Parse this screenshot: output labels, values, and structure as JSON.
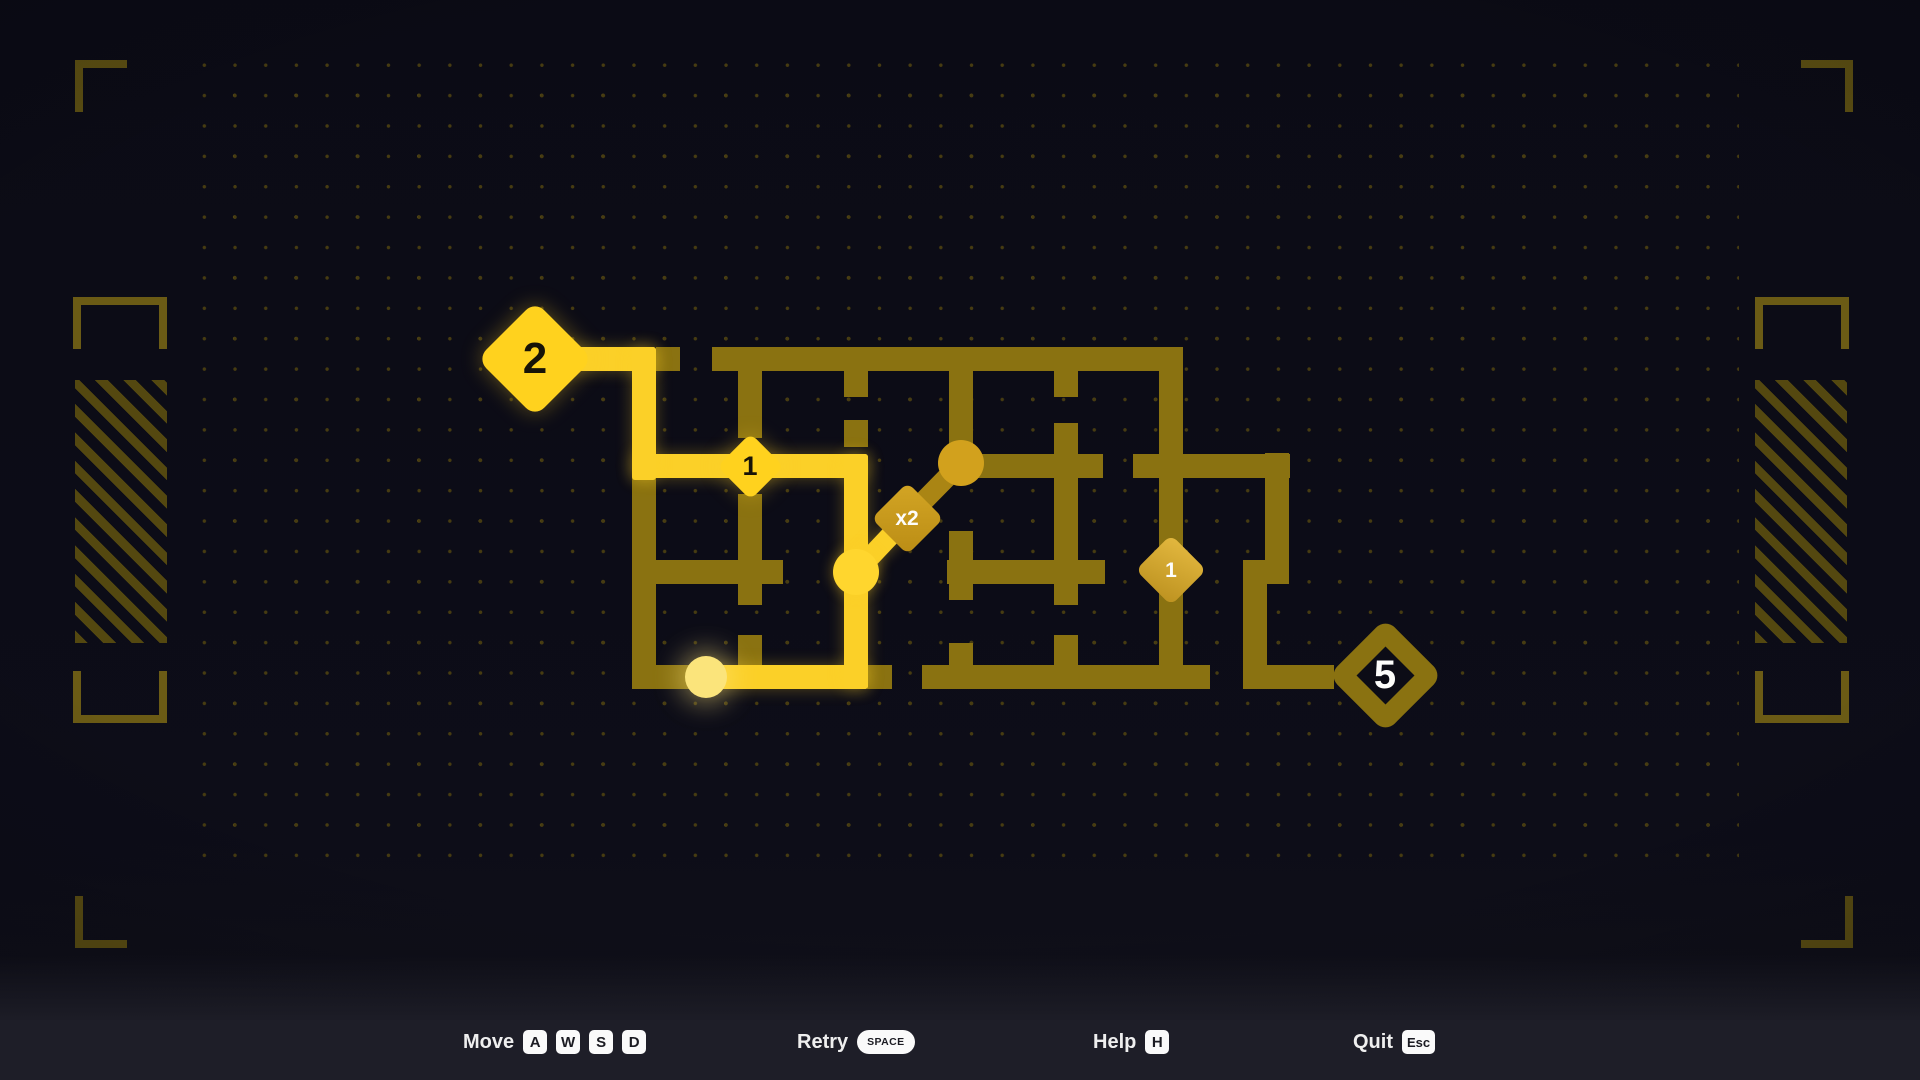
{
  "app": {
    "kind": "maze-path-puzzle-game"
  },
  "colors": {
    "background": "#0d0d17",
    "bar_background": "#1e1e28",
    "corridor_dark": "#8a7211",
    "corridor_mid": "#aa8514",
    "path_bright": "#fbd028",
    "node_bright": "#ffd21e",
    "node_gold": "#d2a11d",
    "player_pale": "#fbe47b",
    "text_white": "#efefef",
    "deco_olive": "#5b4e12",
    "dot": "#473c11"
  },
  "maze": {
    "grid": {
      "row_y": [
        359,
        466,
        572,
        677
      ],
      "col_x": [
        644,
        750,
        856,
        961,
        1066,
        1171,
        1277
      ],
      "corridor_thickness": 24
    },
    "segments": {
      "dark_h": [
        [
          656,
          680,
          359
        ],
        [
          712,
          1183,
          359
        ],
        [
          973,
          1103,
          466
        ],
        [
          1133,
          1290,
          466
        ],
        [
          652,
          783,
          572
        ],
        [
          947,
          1105,
          572
        ],
        [
          1243,
          1289,
          572
        ],
        [
          632,
          714,
          677
        ],
        [
          867,
          892,
          677
        ],
        [
          922,
          1210,
          677
        ],
        [
          1243,
          1334,
          677
        ]
      ],
      "dark_v": [
        [
          476,
          689,
          644
        ],
        [
          365,
          438,
          750
        ],
        [
          494,
          605,
          750
        ],
        [
          635,
          677,
          750
        ],
        [
          368,
          397,
          856
        ],
        [
          420,
          447,
          856
        ],
        [
          368,
          445,
          961
        ],
        [
          531,
          600,
          961
        ],
        [
          643,
          677,
          961
        ],
        [
          368,
          397,
          1066
        ],
        [
          423,
          605,
          1066
        ],
        [
          635,
          677,
          1066
        ],
        [
          368,
          665,
          1171
        ],
        [
          453,
          572,
          1277
        ],
        [
          560,
          689,
          1255
        ]
      ],
      "bright_h": [
        [
          556,
          656,
          359
        ],
        [
          632,
          868,
          466
        ],
        [
          698,
          868,
          677
        ]
      ],
      "bright_v": [
        [
          347,
          480,
          644
        ],
        [
          454,
          689,
          856
        ]
      ],
      "diagonals": [
        {
          "x1": 856,
          "y1": 572,
          "x2": 907,
          "y2": 518,
          "kind": "bright"
        },
        {
          "x1": 907,
          "y1": 518,
          "x2": 961,
          "y2": 463,
          "kind": "mid"
        }
      ]
    },
    "nodes": [
      {
        "type": "circle",
        "name": "waypoint-gold",
        "x": 961,
        "y": 463,
        "r": 23,
        "style": "gold"
      },
      {
        "type": "circle",
        "name": "waypoint-visited",
        "x": 856,
        "y": 572,
        "r": 23,
        "style": "bright"
      },
      {
        "type": "circle",
        "name": "player",
        "x": 706,
        "y": 677,
        "r": 21,
        "style": "player"
      },
      {
        "type": "diamond",
        "name": "start-node",
        "label": "2",
        "x": 535,
        "y": 359,
        "size": 82,
        "style": "bright",
        "text": "darktext",
        "font": 44
      },
      {
        "type": "diamond",
        "name": "counter-node-1",
        "label": "1",
        "x": 750,
        "y": 466,
        "size": 47,
        "style": "bright",
        "text": "darktext",
        "font": 27
      },
      {
        "type": "diamond",
        "name": "multiplier-node",
        "label": "x2",
        "x": 907,
        "y": 518,
        "size": 51,
        "style": "gold",
        "text": "whitetext",
        "font": 21
      },
      {
        "type": "diamond",
        "name": "counter-node-2",
        "label": "1",
        "x": 1171,
        "y": 570,
        "size": 50,
        "style": "gold2",
        "text": "whitetext",
        "font": 21
      },
      {
        "type": "diamond",
        "name": "goal-node",
        "label": "5",
        "x": 1385,
        "y": 675,
        "size": 81,
        "style": "outline",
        "text": "whitetext",
        "font": 40
      }
    ]
  },
  "controls": {
    "move": {
      "label": "Move",
      "keys": [
        "A",
        "W",
        "S",
        "D"
      ]
    },
    "retry": {
      "label": "Retry",
      "key": "SPACE"
    },
    "help": {
      "label": "Help",
      "key": "H"
    },
    "quit": {
      "label": "Quit",
      "key": "Esc"
    }
  }
}
